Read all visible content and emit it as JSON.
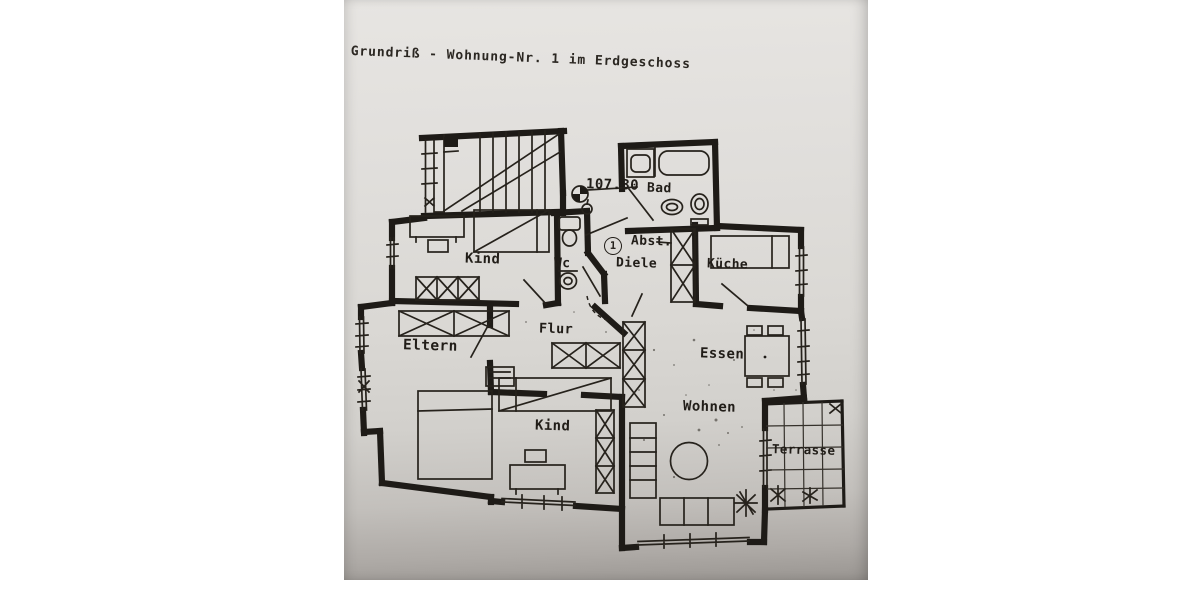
{
  "page": {
    "title": "Grundriß - Wohnung-Nr. 1 im Erdgeschoss"
  },
  "floorplan": {
    "elevation_marker": "107.30",
    "unit_number": "1",
    "rooms": {
      "kind_top": "Kind",
      "wc": "Wc",
      "bad": "Bad",
      "abstellraum": "Abst.",
      "diele": "Diele",
      "kueche": "Küche",
      "eltern": "Eltern",
      "flur": "Flur",
      "essen": "Essen",
      "wohnen": "Wohnen",
      "kind_bottom": "Kind",
      "terrasse": "Terrasse"
    },
    "colors": {
      "ink": "#1e1b17",
      "paper": "#dcdad6",
      "paper_edge_shadow": "#999591",
      "page_margin": "#ffffff"
    }
  }
}
